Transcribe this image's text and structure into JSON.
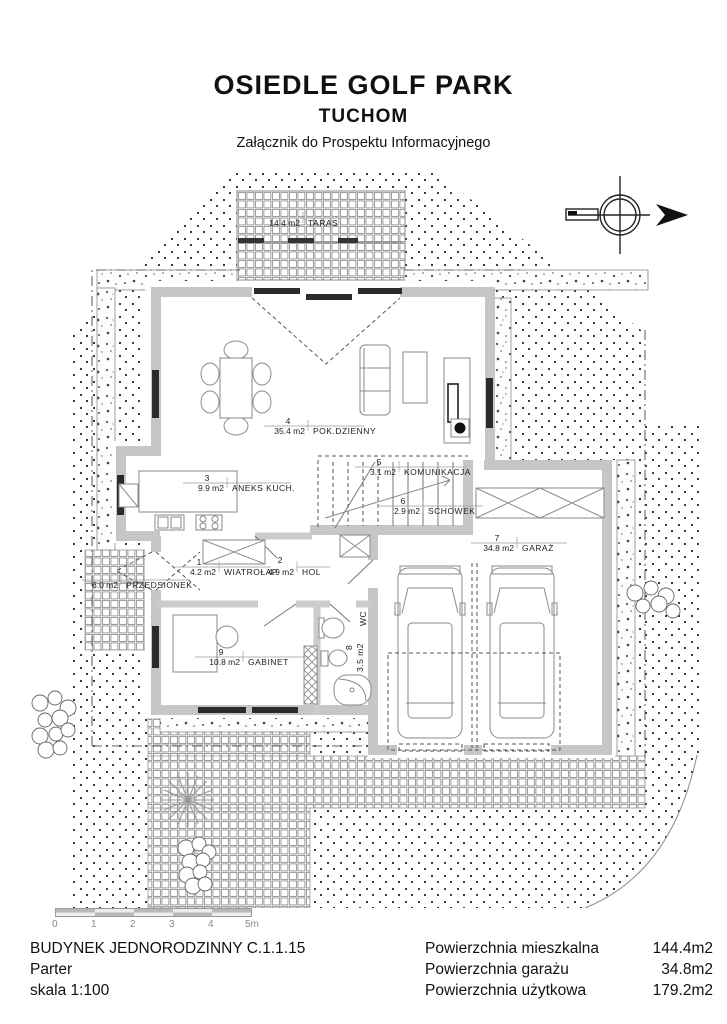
{
  "header": {
    "title": "OSIEDLE GOLF PARK",
    "subtitle": "TUCHOM",
    "note": "Załącznik do Prospektu Informacyjnego"
  },
  "rooms": [
    {
      "num": "1",
      "area": "4.2 m2",
      "name": "WIATROŁAP"
    },
    {
      "num": "2",
      "area": "4.9 m2",
      "name": "HOL"
    },
    {
      "num": "3",
      "area": "9.9 m2",
      "name": "ANEKS KUCH."
    },
    {
      "num": "4",
      "area": "35.4 m2",
      "name": "POK.DZIENNY"
    },
    {
      "num": "5",
      "area": "3.1 m2",
      "name": "KOMUNIKACJA"
    },
    {
      "num": "6",
      "area": "2.9 m2",
      "name": "SCHOWEK"
    },
    {
      "num": "7",
      "area": "34.8 m2",
      "name": "GARAŻ"
    },
    {
      "num": "8",
      "area": "3.5 m2",
      "name": "WC"
    },
    {
      "num": "9",
      "area": "10.8 m2",
      "name": "GABINET"
    }
  ],
  "outdoor": [
    {
      "area": "14.4 m2",
      "name": "TARAS"
    },
    {
      "area": "6.0 m2",
      "name": "PRZEDSIONEK"
    }
  ],
  "scalebar": {
    "ticks": [
      "0",
      "1",
      "2",
      "3",
      "4",
      "5m"
    ]
  },
  "footer": {
    "building": "BUDYNEK JEDNORODZINNY  C.1.1.15",
    "floor": "Parter",
    "scale": "skala 1:100"
  },
  "areas": [
    {
      "label": "Powierzchnia mieszkalna",
      "value": "144.4m2"
    },
    {
      "label": "Powierzchnia garażu",
      "value": "34.8m2"
    },
    {
      "label": "Powierzchnia użytkowa",
      "value": "179.2m2"
    }
  ]
}
